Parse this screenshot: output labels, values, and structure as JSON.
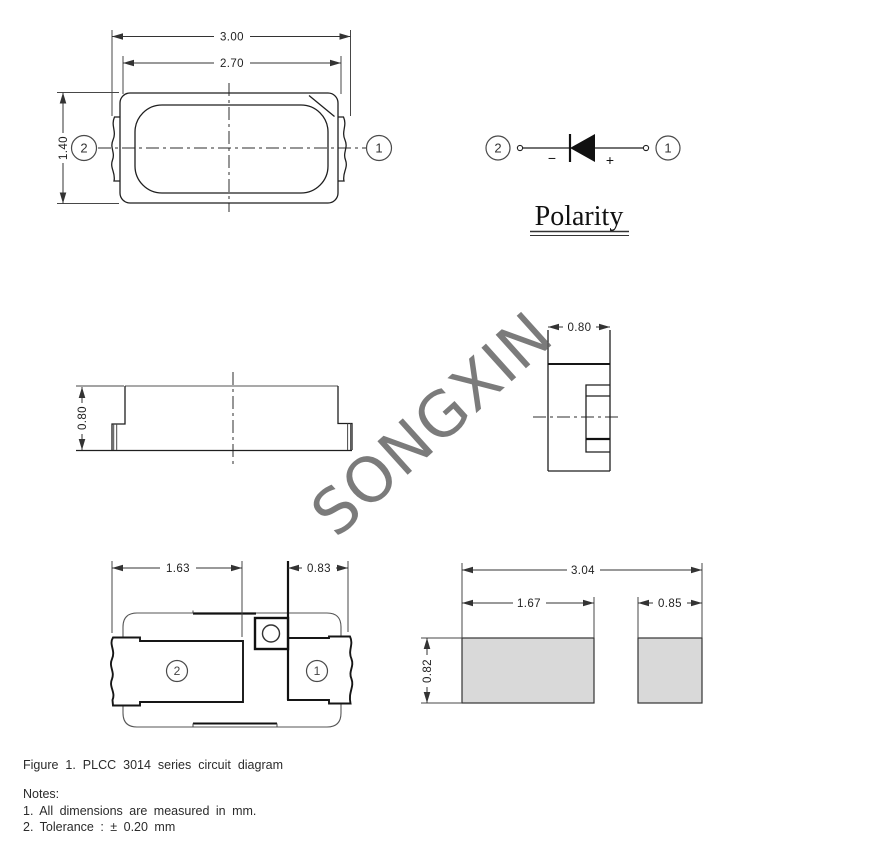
{
  "colors": {
    "line": "#1f1f1f",
    "pad_fill": "#d9d9d9",
    "watermark_gray": "#5f5f5f"
  },
  "watermark": {
    "text": "SONGXIN"
  },
  "views": {
    "top": {
      "dim_outer_width": "3.00",
      "dim_inner_width": "2.70",
      "dim_height": "1.40",
      "pin_left": "2",
      "pin_right": "1"
    },
    "polarity": {
      "title": "Polarity",
      "pin_left": "2",
      "pin_right": "1",
      "minus": "−",
      "plus": "+"
    },
    "side": {
      "dim_height": "0.80"
    },
    "end": {
      "dim_width": "0.80"
    },
    "bottom": {
      "dim_left_pad": "1.63",
      "dim_right_pad": "0.83",
      "pin_left": "2",
      "pin_right": "1"
    },
    "pad_layout": {
      "dim_total": "3.04",
      "dim_left": "1.67",
      "dim_right": "0.85",
      "dim_height": "0.82"
    }
  },
  "caption": {
    "figure": "Figure 1. PLCC 3014 series circuit diagram",
    "notes_title": "Notes:",
    "note_1": "1. All dimensions are measured in mm.",
    "note_2": "2. Tolerance : ± 0.20 mm"
  }
}
